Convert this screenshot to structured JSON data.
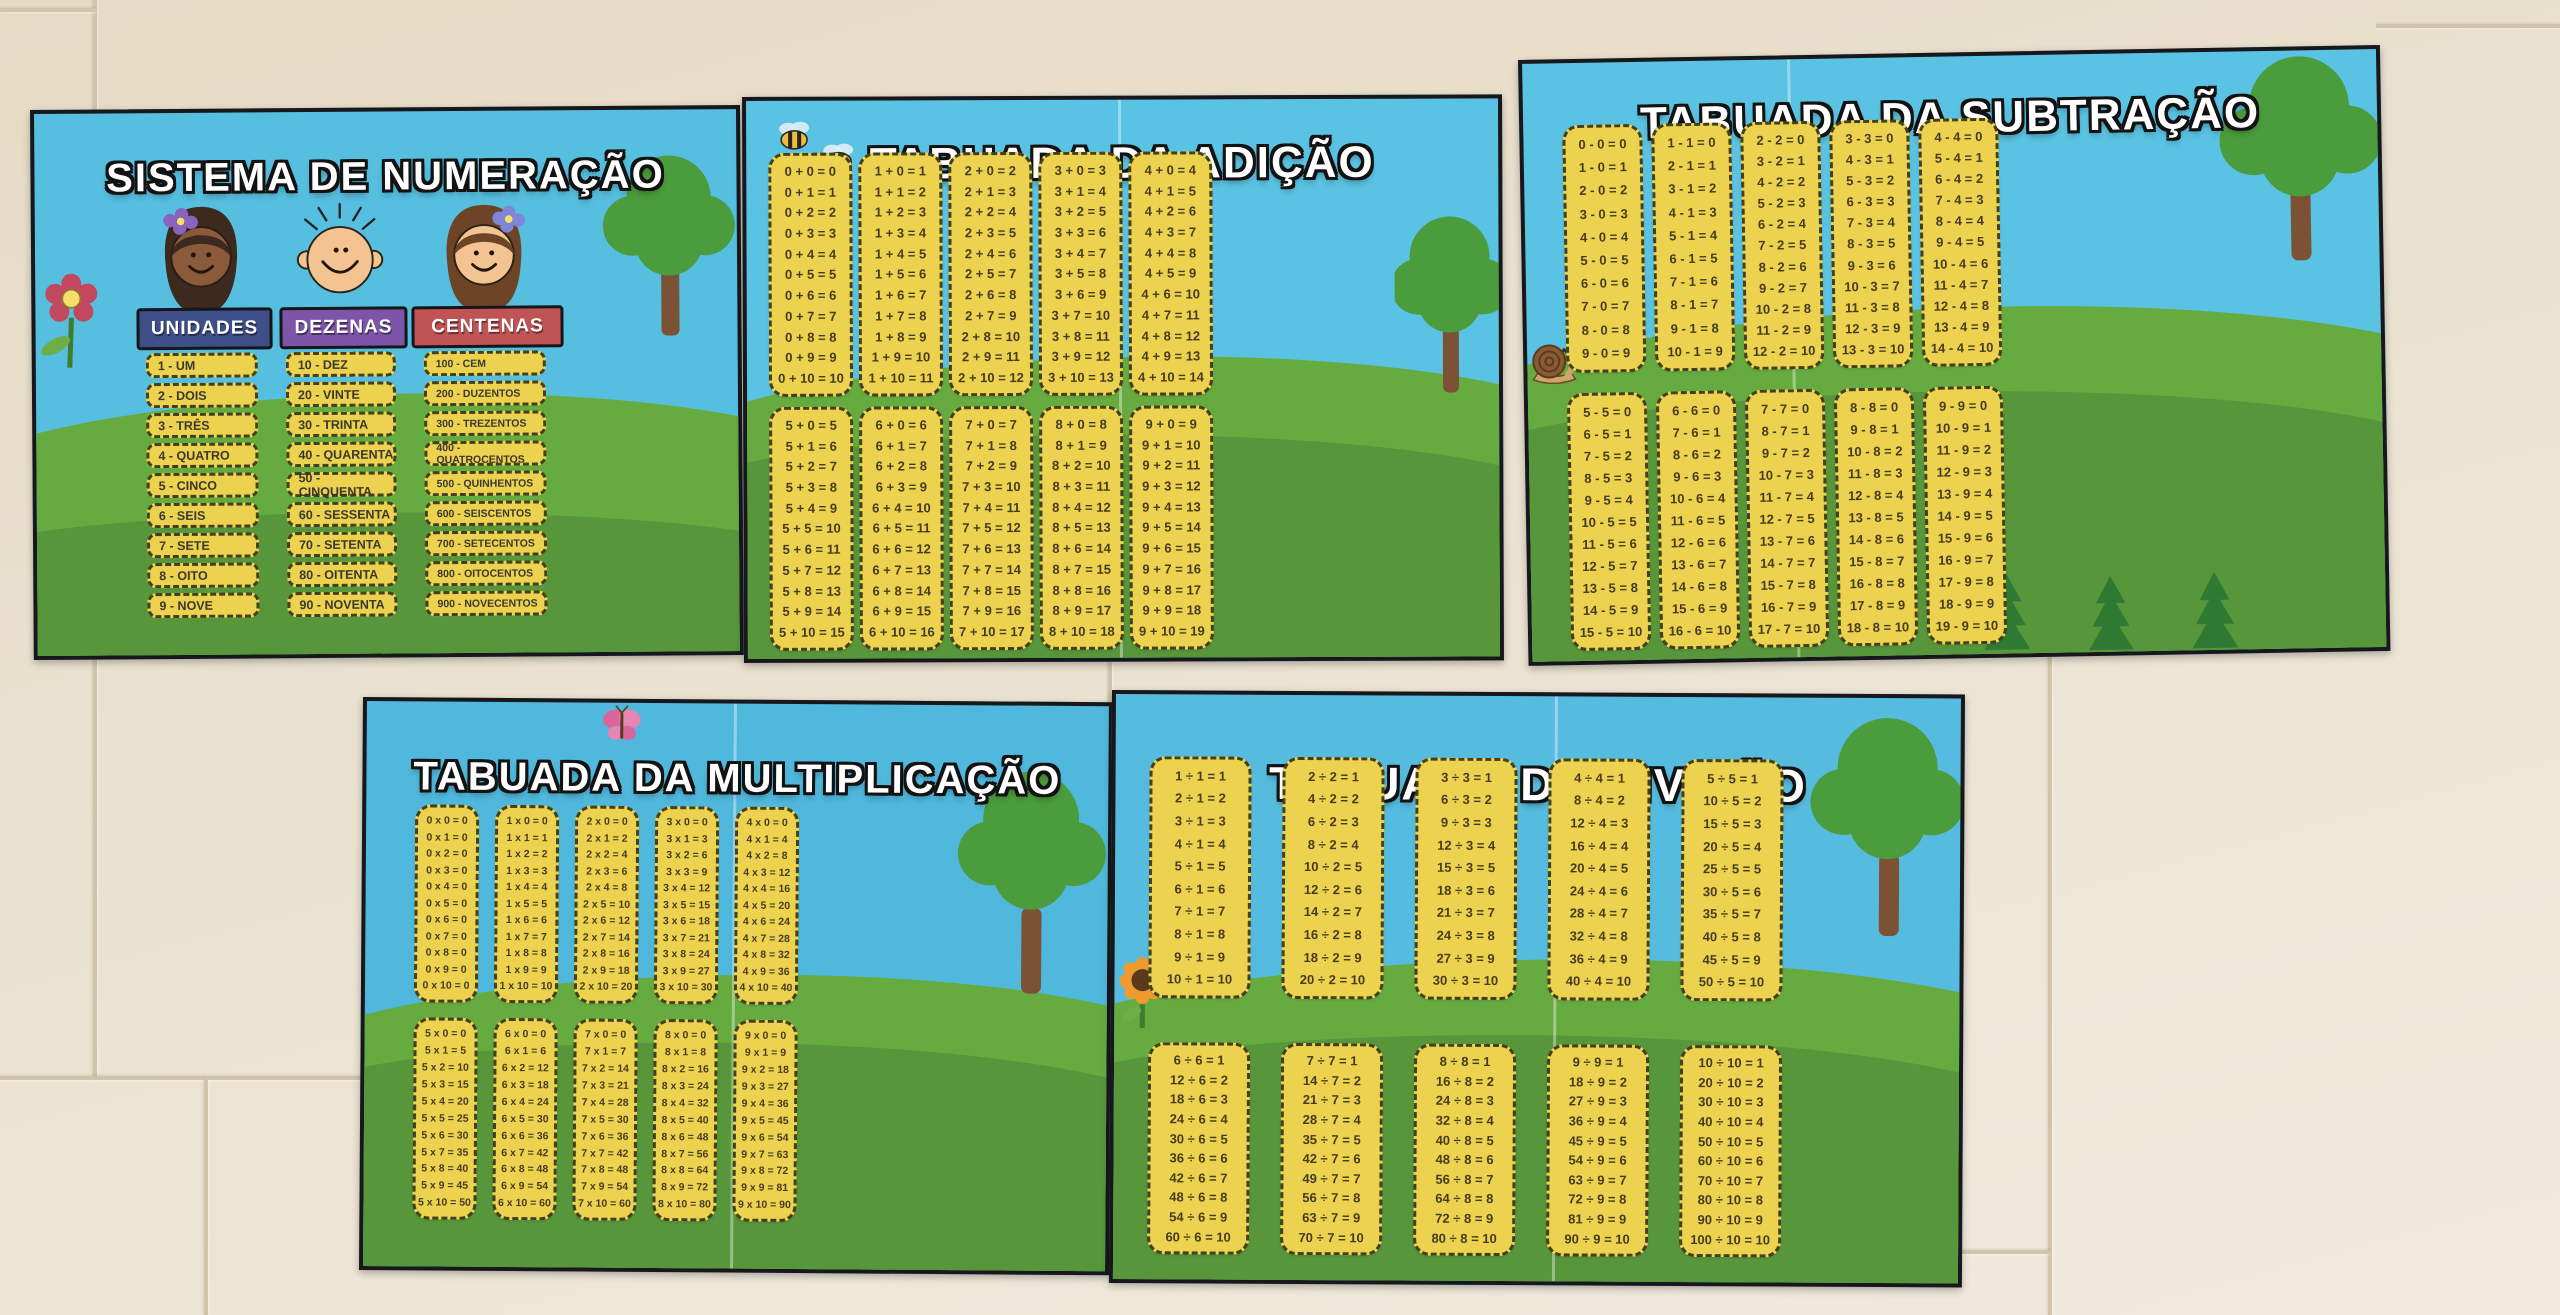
{
  "wall": {
    "tile_color": "#e8decb",
    "grout_color": "#d2c4ab"
  },
  "palette": {
    "sky": "#56bedf",
    "grass_light": "#66ab40",
    "grass_dark": "#57963b",
    "card_yellow": "#ecd24e",
    "card_border": "#41411f",
    "poster_border": "#17171c",
    "unidades_sign": "#3e4f88",
    "dezenas_sign": "#7d55a8",
    "centenas_sign": "#c05454",
    "title_text": "#ffffff"
  },
  "icons": {
    "flower": "red-flower-icon",
    "bee": "bee-icon",
    "snail": "snail-icon",
    "butterfly": "butterfly-icon",
    "sunflower": "sunflower-icon",
    "tree": "tree-icon",
    "fir": "fir-tree-icon",
    "girl_dark_hair": "girl-face-icon",
    "boy_bald": "boy-face-icon",
    "girl_brown_hair": "girl2-face-icon"
  },
  "posters": {
    "numeracao": {
      "title": "SISTEMA DE NUMERAÇÃO",
      "decorations": [
        "red-flower-icon",
        "girl-face-icon",
        "boy-face-icon",
        "girl2-face-icon",
        "tree-icon"
      ],
      "groups": [
        {
          "label": "UNIDADES",
          "color": "#3e4f88",
          "items": [
            "1 - UM",
            "2 - DOIS",
            "3 - TRÊS",
            "4 - QUATRO",
            "5 - CINCO",
            "6 - SEIS",
            "7 - SETE",
            "8 - OITO",
            "9 - NOVE"
          ]
        },
        {
          "label": "DEZENAS",
          "color": "#7d55a8",
          "items": [
            "10 - DEZ",
            "20 - VINTE",
            "30 - TRINTA",
            "40 - QUARENTA",
            "50 - CINQUENTA",
            "60 - SESSENTA",
            "70 - SETENTA",
            "80 - OITENTA",
            "90 - NOVENTA"
          ]
        },
        {
          "label": "CENTENAS",
          "color": "#c05454",
          "items": [
            "100 - CEM",
            "200 - DUZENTOS",
            "300 - TREZENTOS",
            "400 - QUATROCENTOS",
            "500 - QUINHENTOS",
            "600 - SEISCENTOS",
            "700 - SETECENTOS",
            "800 - OITOCENTOS",
            "900 - NOVECENTOS"
          ]
        }
      ]
    },
    "adicao": {
      "title": "TABUADA DA ADIÇÃO",
      "decorations": [
        "bee-icon",
        "bee-icon",
        "tree-icon"
      ],
      "columns_top": [
        [
          "0 + 0 = 0",
          "0 + 1 = 1",
          "0 + 2 = 2",
          "0 + 3 = 3",
          "0 + 4 = 4",
          "0 + 5 = 5",
          "0 + 6 = 6",
          "0 + 7 = 7",
          "0 + 8 = 8",
          "0 + 9 = 9",
          "0 + 10 = 10"
        ],
        [
          "1 + 0 = 1",
          "1 + 1 = 2",
          "1 + 2 = 3",
          "1 + 3 = 4",
          "1 + 4 = 5",
          "1 + 5 = 6",
          "1 + 6 = 7",
          "1 + 7 = 8",
          "1 + 8 = 9",
          "1 + 9 = 10",
          "1 + 10 = 11"
        ],
        [
          "2 + 0 = 2",
          "2 + 1 = 3",
          "2 + 2 = 4",
          "2 + 3 = 5",
          "2 + 4 = 6",
          "2 + 5 = 7",
          "2 + 6 = 8",
          "2 + 7 = 9",
          "2 + 8 = 10",
          "2 + 9 = 11",
          "2 + 10 = 12"
        ],
        [
          "3 + 0 = 3",
          "3 + 1 = 4",
          "3 + 2 = 5",
          "3 + 3 = 6",
          "3 + 4 = 7",
          "3 + 5 = 8",
          "3 + 6 = 9",
          "3 + 7 = 10",
          "3 + 8 = 11",
          "3 + 9 = 12",
          "3 + 10 = 13"
        ],
        [
          "4 + 0 = 4",
          "4 + 1 = 5",
          "4 + 2 = 6",
          "4 + 3 = 7",
          "4 + 4 = 8",
          "4 + 5 = 9",
          "4 + 6 = 10",
          "4 + 7 = 11",
          "4 + 8 = 12",
          "4 + 9 = 13",
          "4 + 10 = 14"
        ]
      ],
      "columns_bottom": [
        [
          "5 + 0 = 5",
          "5 + 1 = 6",
          "5 + 2 = 7",
          "5 + 3 = 8",
          "5 + 4 = 9",
          "5 + 5 = 10",
          "5 + 6 = 11",
          "5 + 7 = 12",
          "5 + 8 = 13",
          "5 + 9 = 14",
          "5 + 10 = 15"
        ],
        [
          "6 + 0 = 6",
          "6 + 1 = 7",
          "6 + 2 = 8",
          "6 + 3 = 9",
          "6 + 4 = 10",
          "6 + 5 = 11",
          "6 + 6 = 12",
          "6 + 7 = 13",
          "6 + 8 = 14",
          "6 + 9 = 15",
          "6 + 10 = 16"
        ],
        [
          "7 + 0 = 7",
          "7 + 1 = 8",
          "7 + 2 = 9",
          "7 + 3 = 10",
          "7 + 4 = 11",
          "7 + 5 = 12",
          "7 + 6 = 13",
          "7 + 7 = 14",
          "7 + 8 = 15",
          "7 + 9 = 16",
          "7 + 10 = 17"
        ],
        [
          "8 + 0 = 8",
          "8 + 1 = 9",
          "8 + 2 = 10",
          "8 + 3 = 11",
          "8 + 4 = 12",
          "8 + 5 = 13",
          "8 + 6 = 14",
          "8 + 7 = 15",
          "8 + 8 = 16",
          "8 + 9 = 17",
          "8 + 10 = 18"
        ],
        [
          "9 + 0 = 9",
          "9 + 1 = 10",
          "9 + 2 = 11",
          "9 + 3 = 12",
          "9 + 4 = 13",
          "9 + 5 = 14",
          "9 + 6 = 15",
          "9 + 7 = 16",
          "9 + 8 = 17",
          "9 + 9 = 18",
          "9 + 10 = 19"
        ]
      ]
    },
    "subtracao": {
      "title": "TABUADA DA SUBTRAÇÃO",
      "decorations": [
        "snail-icon",
        "tree-icon",
        "fir-tree-icon"
      ],
      "columns_top": [
        [
          "0 - 0 = 0",
          "1 - 0 = 1",
          "2 - 0 = 2",
          "3 - 0 = 3",
          "4 - 0 = 4",
          "5 - 0 = 5",
          "6 - 0 = 6",
          "7 - 0 = 7",
          "8 - 0 = 8",
          "9 - 0 = 9"
        ],
        [
          "1 - 1 = 0",
          "2 - 1 = 1",
          "3 - 1 = 2",
          "4 - 1 = 3",
          "5 - 1 = 4",
          "6 - 1 = 5",
          "7 - 1 = 6",
          "8 - 1 = 7",
          "9 - 1 = 8",
          "10 - 1 = 9"
        ],
        [
          "2 - 2 = 0",
          "3 - 2 = 1",
          "4 - 2 = 2",
          "5 - 2 = 3",
          "6 - 2 = 4",
          "7 - 2 = 5",
          "8 - 2 = 6",
          "9 - 2 = 7",
          "10 - 2 = 8",
          "11 - 2 = 9",
          "12 - 2 = 10"
        ],
        [
          "3 - 3 = 0",
          "4 - 3 = 1",
          "5 - 3 = 2",
          "6 - 3 = 3",
          "7 - 3 = 4",
          "8 - 3 = 5",
          "9 - 3 = 6",
          "10 - 3 = 7",
          "11 - 3 = 8",
          "12 - 3 = 9",
          "13 - 3 = 10"
        ],
        [
          "4 - 4 = 0",
          "5 - 4 = 1",
          "6 - 4 = 2",
          "7 - 4 = 3",
          "8 - 4 = 4",
          "9 - 4 = 5",
          "10 - 4 = 6",
          "11 - 4 = 7",
          "12 - 4 = 8",
          "13 - 4 = 9",
          "14 - 4 = 10"
        ]
      ],
      "columns_bottom": [
        [
          "5 - 5 = 0",
          "6 - 5 = 1",
          "7 - 5 = 2",
          "8 - 5 = 3",
          "9 - 5 = 4",
          "10 - 5 = 5",
          "11 - 5 = 6",
          "12 - 5 = 7",
          "13 - 5 = 8",
          "14 - 5 = 9",
          "15 - 5 = 10"
        ],
        [
          "6 - 6 = 0",
          "7 - 6 = 1",
          "8 - 6 = 2",
          "9 - 6 = 3",
          "10 - 6 = 4",
          "11 - 6 = 5",
          "12 - 6 = 6",
          "13 - 6 = 7",
          "14 - 6 = 8",
          "15 - 6 = 9",
          "16 - 6 = 10"
        ],
        [
          "7 - 7 = 0",
          "8 - 7 = 1",
          "9 - 7 = 2",
          "10 - 7 = 3",
          "11 - 7 = 4",
          "12 - 7 = 5",
          "13 - 7 = 6",
          "14 - 7 = 7",
          "15 - 7 = 8",
          "16 - 7 = 9",
          "17 - 7 = 10"
        ],
        [
          "8 - 8 = 0",
          "9 - 8 = 1",
          "10 - 8 = 2",
          "11 - 8 = 3",
          "12 - 8 = 4",
          "13 - 8 = 5",
          "14 - 8 = 6",
          "15 - 8 = 7",
          "16 - 8 = 8",
          "17 - 8 = 9",
          "18 - 8 = 10"
        ],
        [
          "9 - 9 = 0",
          "10 - 9 = 1",
          "11 - 9 = 2",
          "12 - 9 = 3",
          "13 - 9 = 4",
          "14 - 9 = 5",
          "15 - 9 = 6",
          "16 - 9 = 7",
          "17 - 9 = 8",
          "18 - 9 = 9",
          "19 - 9 = 10"
        ]
      ]
    },
    "multiplicacao": {
      "title": "TABUADA DA MULTIPLICAÇÃO",
      "decorations": [
        "butterfly-icon",
        "tree-icon"
      ],
      "columns_top": [
        [
          "0 x 0 = 0",
          "0 x 1 = 0",
          "0 x 2 = 0",
          "0 x 3 = 0",
          "0 x 4 = 0",
          "0 x 5 = 0",
          "0 x 6 = 0",
          "0 x 7 = 0",
          "0 x 8 = 0",
          "0 x 9 = 0",
          "0 x 10 = 0"
        ],
        [
          "1 x 0 = 0",
          "1 x 1 = 1",
          "1 x 2 = 2",
          "1 x 3 = 3",
          "1 x 4 = 4",
          "1 x 5 = 5",
          "1 x 6 = 6",
          "1 x 7 = 7",
          "1 x 8 = 8",
          "1 x 9 = 9",
          "1 x 10 = 10"
        ],
        [
          "2 x 0 = 0",
          "2 x 1 = 2",
          "2 x 2 = 4",
          "2 x 3 = 6",
          "2 x 4 = 8",
          "2 x 5 = 10",
          "2 x 6 = 12",
          "2 x 7 = 14",
          "2 x 8 = 16",
          "2 x 9 = 18",
          "2 x 10 = 20"
        ],
        [
          "3 x 0 = 0",
          "3 x 1 = 3",
          "3 x 2 = 6",
          "3 x 3 = 9",
          "3 x 4 = 12",
          "3 x 5 = 15",
          "3 x 6 = 18",
          "3 x 7 = 21",
          "3 x 8 = 24",
          "3 x 9 = 27",
          "3 x 10 = 30"
        ],
        [
          "4 x 0 = 0",
          "4 x 1 = 4",
          "4 x 2 = 8",
          "4 x 3 = 12",
          "4 x 4 = 16",
          "4 x 5 = 20",
          "4 x 6 = 24",
          "4 x 7 = 28",
          "4 x 8 = 32",
          "4 x 9 = 36",
          "4 x 10 = 40"
        ]
      ],
      "columns_bottom": [
        [
          "5 x 0 = 0",
          "5 x 1 = 5",
          "5 x 2 = 10",
          "5 x 3 = 15",
          "5 x 4 = 20",
          "5 x 5 = 25",
          "5 x 6 = 30",
          "5 x 7 = 35",
          "5 x 8 = 40",
          "5 x 9 = 45",
          "5 x 10 = 50"
        ],
        [
          "6 x 0 = 0",
          "6 x 1 = 6",
          "6 x 2 = 12",
          "6 x 3 = 18",
          "6 x 4 = 24",
          "6 x 5 = 30",
          "6 x 6 = 36",
          "6 x 7 = 42",
          "6 x 8 = 48",
          "6 x 9 = 54",
          "6 x 10 = 60"
        ],
        [
          "7 x 0 = 0",
          "7 x 1 = 7",
          "7 x 2 = 14",
          "7 x 3 = 21",
          "7 x 4 = 28",
          "7 x 5 = 30",
          "7 x 6 = 36",
          "7 x 7 = 42",
          "7 x 8 = 48",
          "7 x 9 = 54",
          "7 x 10 = 60"
        ],
        [
          "8 x 0 = 0",
          "8 x 1 = 8",
          "8 x 2 = 16",
          "8 x 3 = 24",
          "8 x 4 = 32",
          "8 x 5 = 40",
          "8 x 6 = 48",
          "8 x 7 = 56",
          "8 x 8 = 64",
          "8 x 9 = 72",
          "8 x 10 = 80"
        ],
        [
          "9 x 0 = 0",
          "9 x 1 = 9",
          "9 x 2 = 18",
          "9 x 3 = 27",
          "9 x 4 = 36",
          "9 x 5 = 45",
          "9 x 6 = 54",
          "9 x 7 = 63",
          "9 x 8 = 72",
          "9 x 9 = 81",
          "9 x 10 = 90"
        ]
      ]
    },
    "divisao": {
      "title": "TABUADA DA DIVISÃO",
      "decorations": [
        "sunflower-icon",
        "tree-icon"
      ],
      "columns_top": [
        [
          "1 ÷ 1 = 1",
          "2 ÷ 1 = 2",
          "3 ÷ 1 = 3",
          "4 ÷ 1 = 4",
          "5 ÷ 1 = 5",
          "6 ÷ 1 = 6",
          "7 ÷ 1 = 7",
          "8 ÷ 1 = 8",
          "9 ÷ 1 = 9",
          "10 ÷ 1 = 10"
        ],
        [
          "2 ÷ 2 = 1",
          "4 ÷ 2 = 2",
          "6 ÷ 2 = 3",
          "8 ÷ 2 = 4",
          "10 ÷ 2 = 5",
          "12 ÷ 2 = 6",
          "14 ÷ 2 = 7",
          "16 ÷ 2 = 8",
          "18 ÷ 2 = 9",
          "20 ÷ 2 = 10"
        ],
        [
          "3 ÷ 3 = 1",
          "6 ÷ 3 = 2",
          "9 ÷ 3 = 3",
          "12 ÷ 3 = 4",
          "15 ÷ 3 = 5",
          "18 ÷ 3 = 6",
          "21 ÷ 3 = 7",
          "24 ÷ 3 = 8",
          "27 ÷ 3 = 9",
          "30 ÷ 3 = 10"
        ],
        [
          "4 ÷ 4 = 1",
          "8 ÷ 4 = 2",
          "12 ÷ 4 = 3",
          "16 ÷ 4 = 4",
          "20 ÷ 4 = 5",
          "24 ÷ 4 = 6",
          "28 ÷ 4 = 7",
          "32 ÷ 4 = 8",
          "36 ÷ 4 = 9",
          "40 ÷ 4 = 10"
        ],
        [
          "5 ÷ 5 = 1",
          "10 ÷ 5 = 2",
          "15 ÷ 5 = 3",
          "20 ÷ 5 = 4",
          "25 ÷ 5 = 5",
          "30 ÷ 5 = 6",
          "35 ÷ 5 = 7",
          "40 ÷ 5 = 8",
          "45 ÷ 5 = 9",
          "50 ÷ 5 = 10"
        ]
      ],
      "columns_bottom": [
        [
          "6 ÷ 6 = 1",
          "12 ÷ 6 = 2",
          "18 ÷ 6 = 3",
          "24 ÷ 6 = 4",
          "30 ÷ 6 = 5",
          "36 ÷ 6 = 6",
          "42 ÷ 6 = 7",
          "48 ÷ 6 = 8",
          "54 ÷ 6 = 9",
          "60 ÷ 6 = 10"
        ],
        [
          "7 ÷ 7 = 1",
          "14 ÷ 7 = 2",
          "21 ÷ 7 = 3",
          "28 ÷ 7 = 4",
          "35 ÷ 7 = 5",
          "42 ÷ 7 = 6",
          "49 ÷ 7 = 7",
          "56 ÷ 7 = 8",
          "63 ÷ 7 = 9",
          "70 ÷ 7 = 10"
        ],
        [
          "8 ÷ 8 = 1",
          "16 ÷ 8 = 2",
          "24 ÷ 8 = 3",
          "32 ÷ 8 = 4",
          "40 ÷ 8 = 5",
          "48 ÷ 8 = 6",
          "56 ÷ 8 = 7",
          "64 ÷ 8 = 8",
          "72 ÷ 8 = 9",
          "80 ÷ 8 = 10"
        ],
        [
          "9 ÷ 9 = 1",
          "18 ÷ 9 = 2",
          "27 ÷ 9 = 3",
          "36 ÷ 9 = 4",
          "45 ÷ 9 = 5",
          "54 ÷ 9 = 6",
          "63 ÷ 9 = 7",
          "72 ÷ 9 = 8",
          "81 ÷ 9 = 9",
          "90 ÷ 9 = 10"
        ],
        [
          "10 ÷ 10 = 1",
          "20 ÷ 10 = 2",
          "30 ÷ 10 = 3",
          "40 ÷ 10 = 4",
          "50 ÷ 10 = 5",
          "60 ÷ 10 = 6",
          "70 ÷ 10 = 7",
          "80 ÷ 10 = 8",
          "90 ÷ 10 = 9",
          "100 ÷ 10 = 10"
        ]
      ]
    }
  }
}
